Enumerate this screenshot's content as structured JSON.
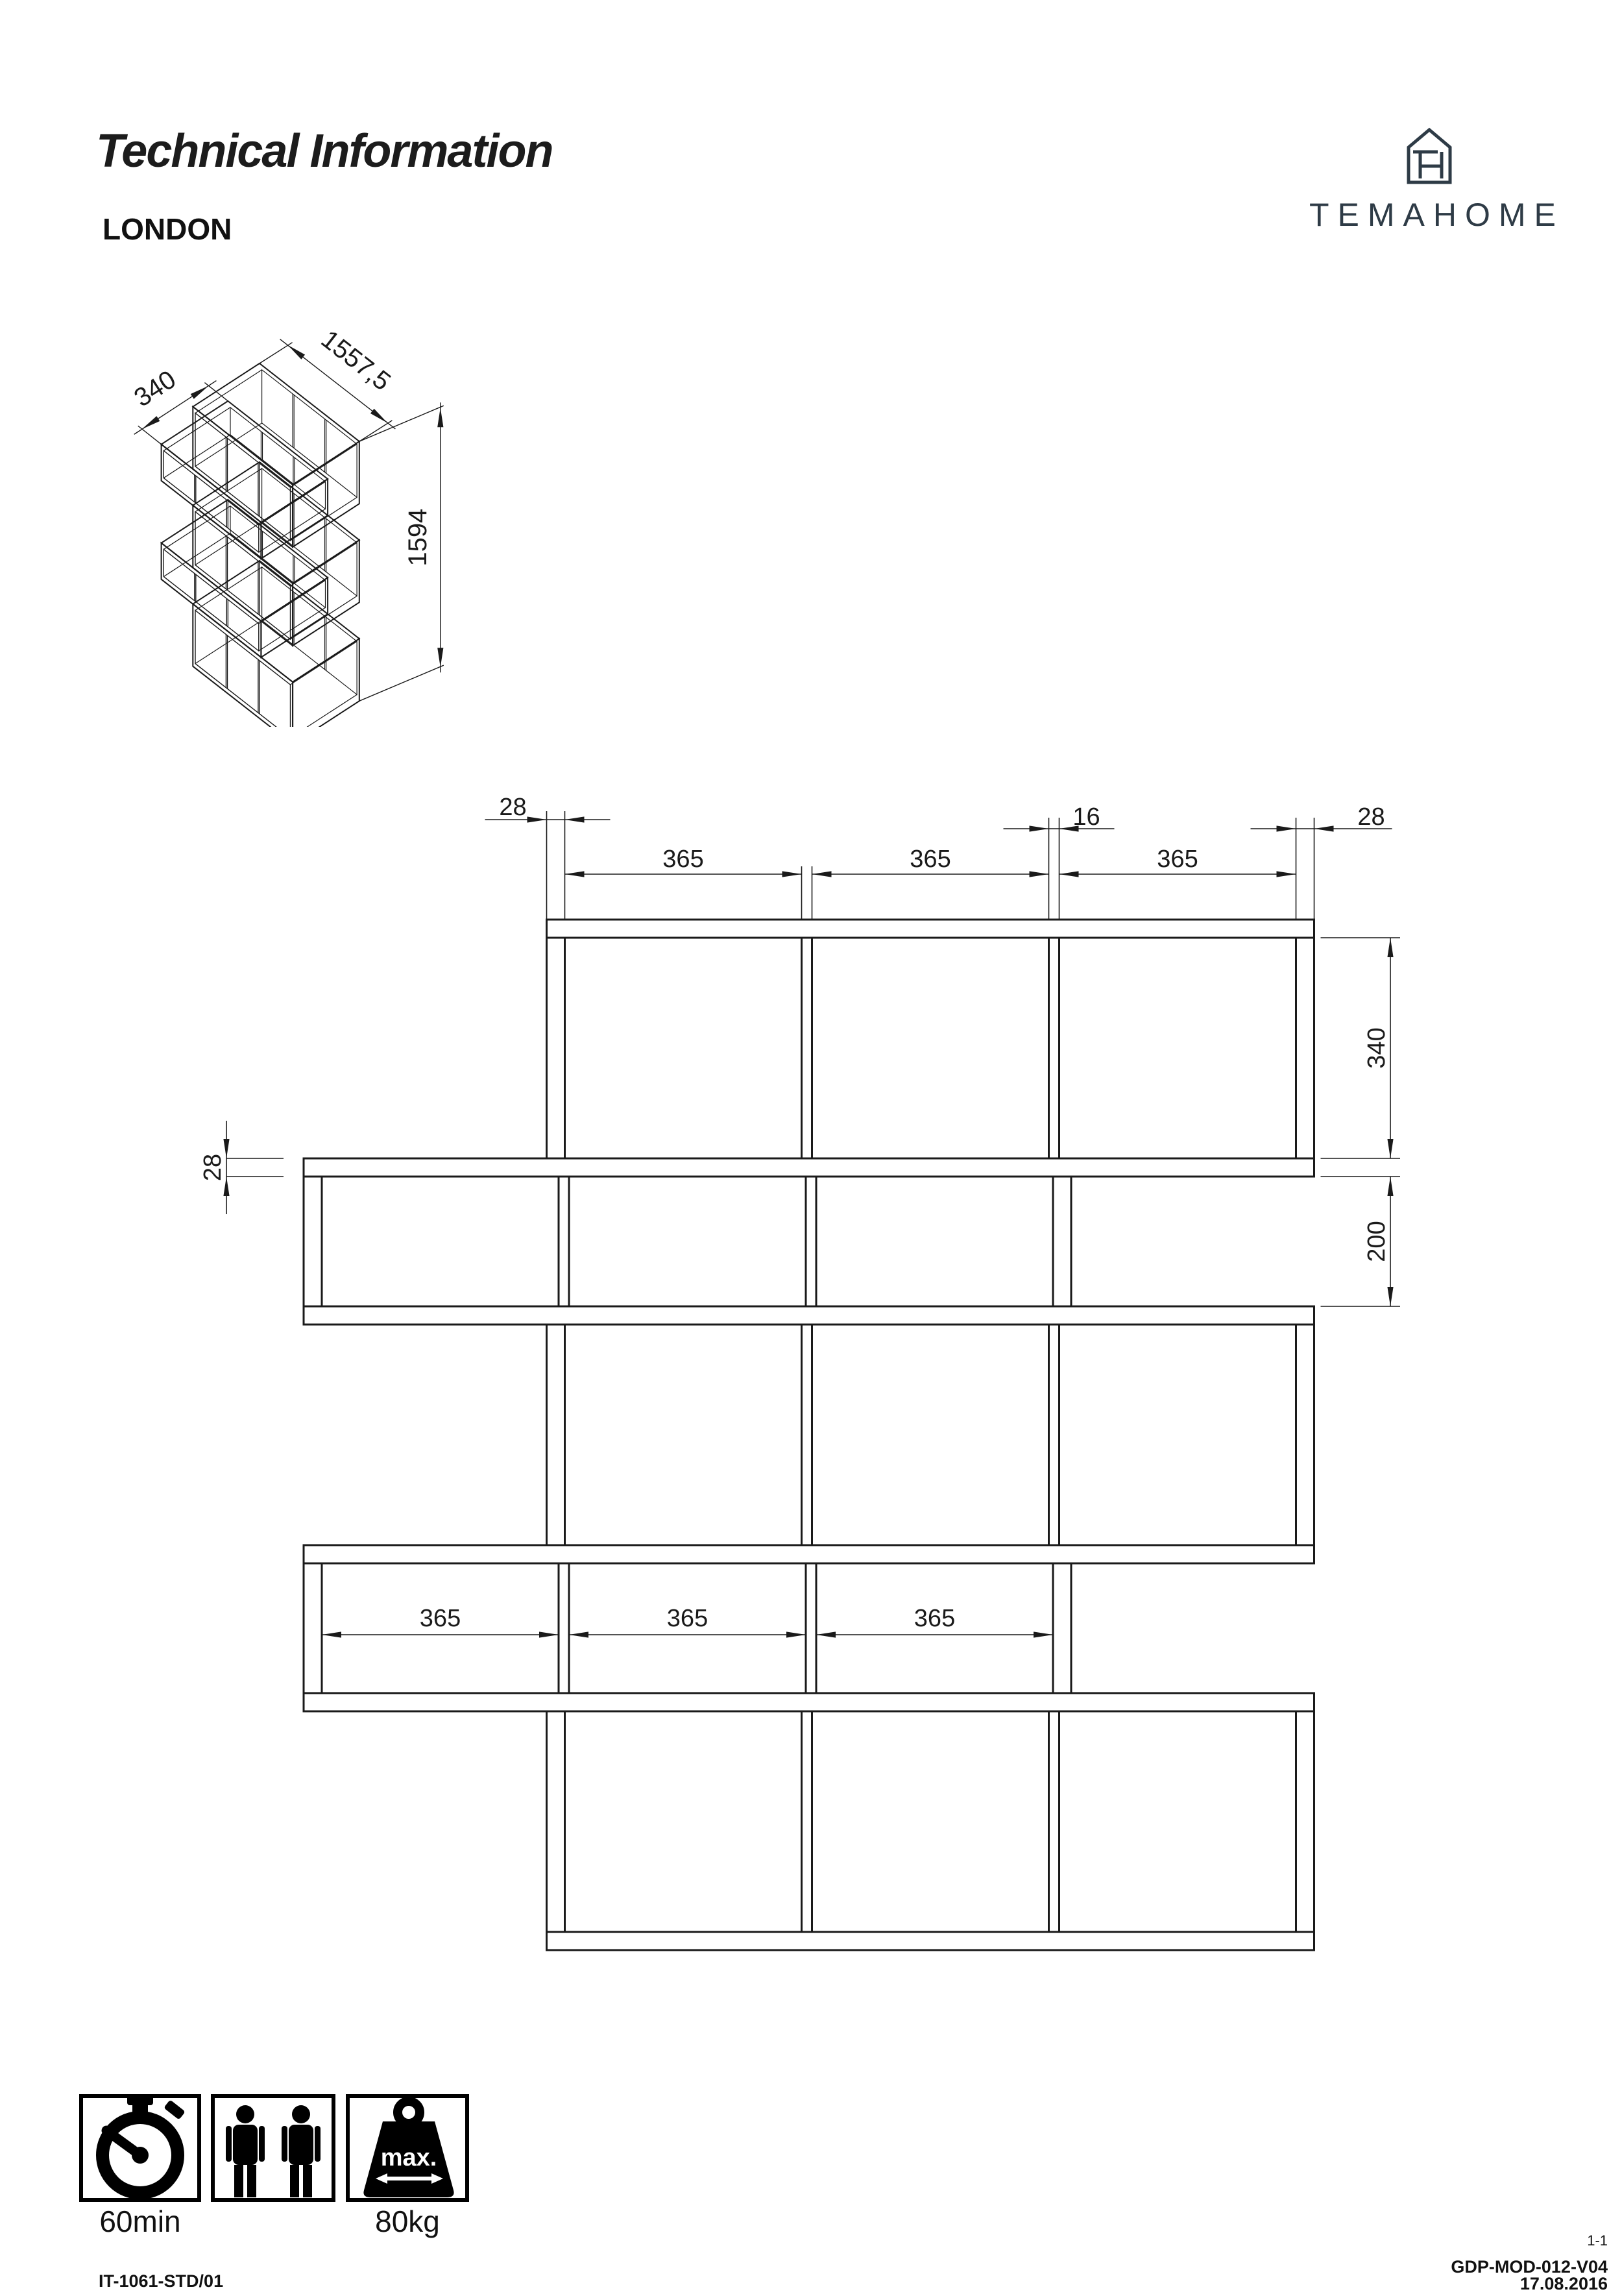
{
  "header": {
    "title": "Technical Information",
    "product": "LONDON"
  },
  "brand": {
    "name": "TEMAHOME",
    "monogram": "TH",
    "color": "#2e3b46"
  },
  "iso_view": {
    "labels": {
      "depth": "340",
      "width": "1557,5",
      "height": "1594"
    }
  },
  "front_view": {
    "labels": {
      "panel_left_top": "28",
      "divider_top": "16",
      "panel_right_top": "28",
      "compartment": "365",
      "tall_row": "340",
      "short_row": "200",
      "shelf_thickness": "28"
    },
    "mm": {
      "panel": 28,
      "divider": 16,
      "compartment": 365,
      "tall_interior": 340,
      "short_interior": 200,
      "row_offset": 374.5,
      "total_width": 1557.5,
      "total_height": 1594
    }
  },
  "icons": [
    {
      "name": "assembly-time",
      "label": "60min"
    },
    {
      "name": "people-required",
      "label": ""
    },
    {
      "name": "max-load",
      "label": "80kg",
      "badge": "max."
    }
  ],
  "footer": {
    "doc_code": "IT-1061-STD/01",
    "page": "1-1",
    "reference": "GDP-MOD-012-V04",
    "date": "17.08.2016"
  }
}
